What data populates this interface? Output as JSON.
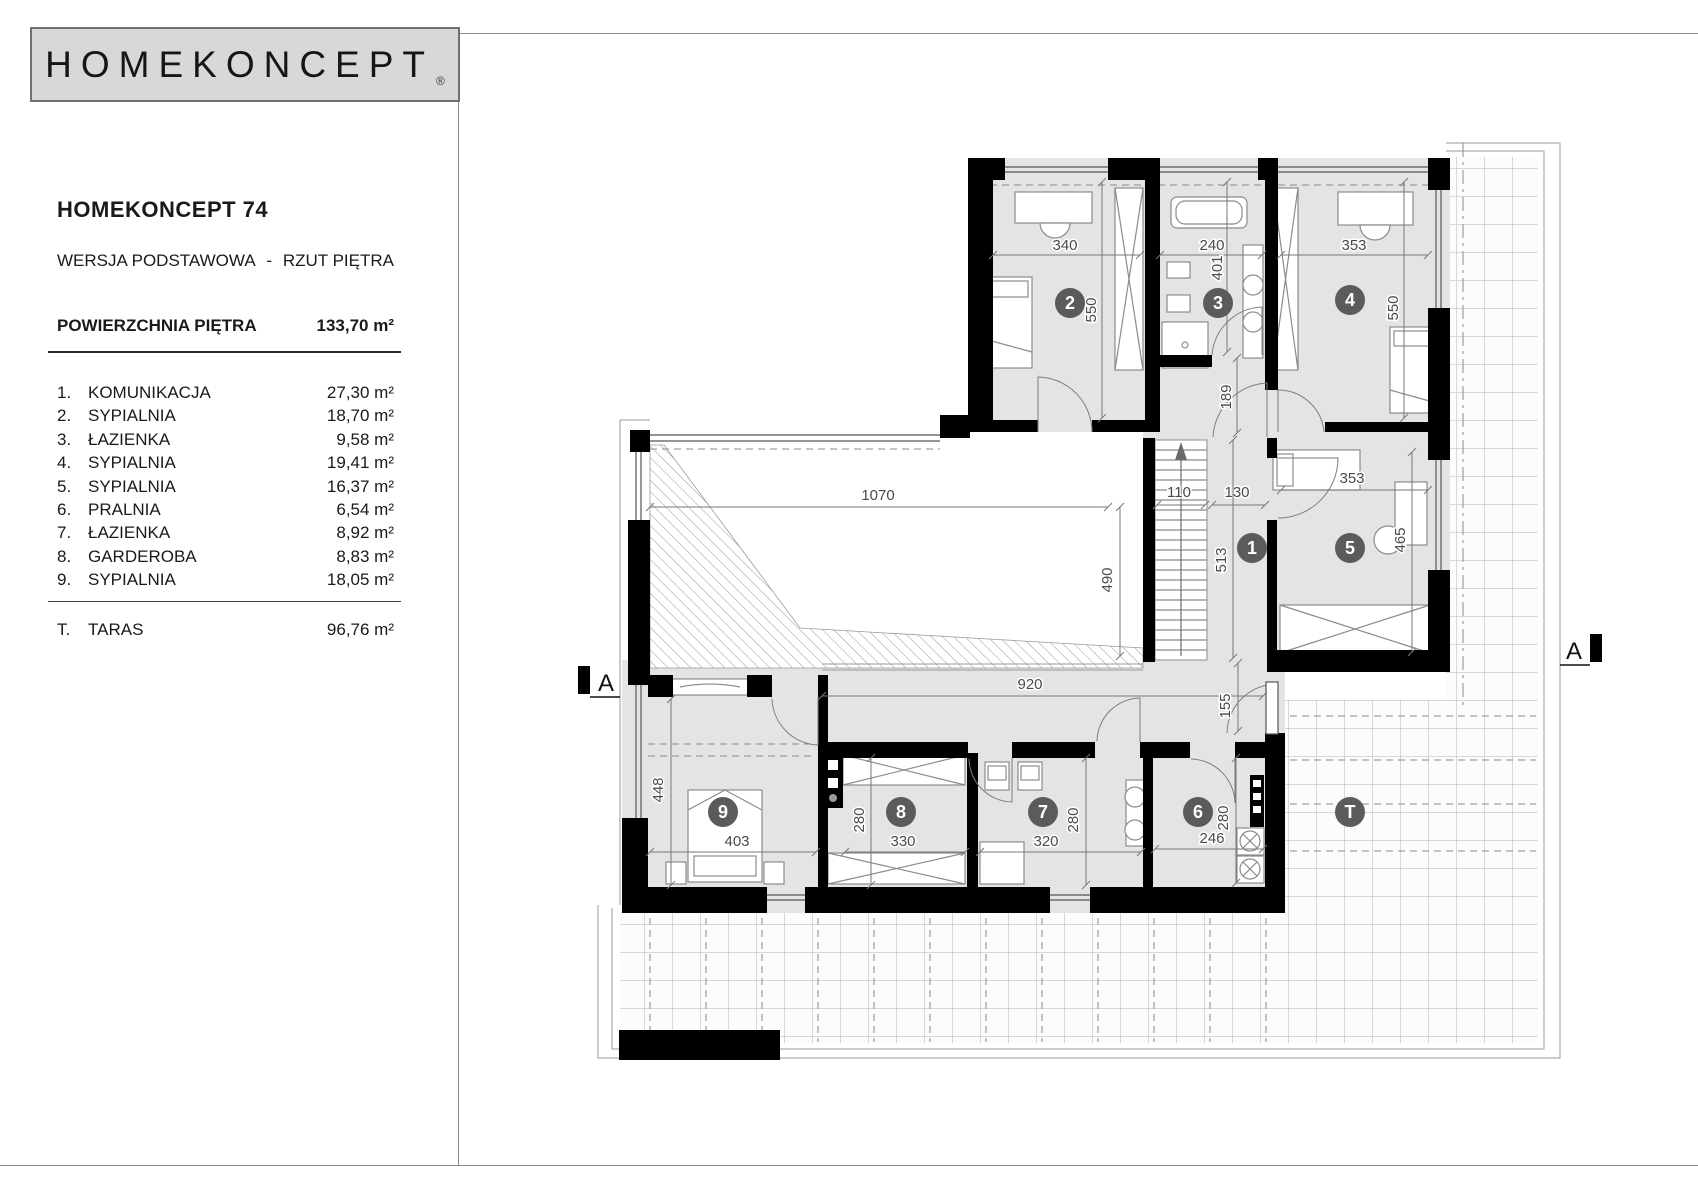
{
  "logo": {
    "text": "HOMEKONCEPT",
    "registered": "®"
  },
  "sidebar": {
    "title": "HOMEKONCEPT 74",
    "subtitle_left": "WERSJA PODSTAWOWA",
    "subtitle_dash": "-",
    "subtitle_right": "RZUT PIĘTRA",
    "area_label": "POWIERZCHNIA PIĘTRA",
    "area_value": "133,70 m²",
    "rooms": [
      {
        "no": "1.",
        "name": "KOMUNIKACJA",
        "area": "27,30 m²"
      },
      {
        "no": "2.",
        "name": "SYPIALNIA",
        "area": "18,70 m²"
      },
      {
        "no": "3.",
        "name": "ŁAZIENKA",
        "area": "9,58 m²"
      },
      {
        "no": "4.",
        "name": "SYPIALNIA",
        "area": "19,41 m²"
      },
      {
        "no": "5.",
        "name": "SYPIALNIA",
        "area": "16,37 m²"
      },
      {
        "no": "6.",
        "name": "PRALNIA",
        "area": "6,54 m²"
      },
      {
        "no": "7.",
        "name": "ŁAZIENKA",
        "area": "8,92 m²"
      },
      {
        "no": "8.",
        "name": "GARDEROBA",
        "area": "8,83 m²"
      },
      {
        "no": "9.",
        "name": "SYPIALNIA",
        "area": "18,05 m²"
      }
    ],
    "terrace_row": {
      "no": "T.",
      "name": "TARAS",
      "area": "96,76 m²"
    }
  },
  "plan": {
    "section_markers": {
      "left": "A",
      "right": "A"
    },
    "room_markers": [
      {
        "t": "1",
        "x": 1252,
        "y": 548
      },
      {
        "t": "2",
        "x": 1070,
        "y": 303
      },
      {
        "t": "3",
        "x": 1218,
        "y": 303
      },
      {
        "t": "4",
        "x": 1350,
        "y": 300
      },
      {
        "t": "5",
        "x": 1350,
        "y": 548
      },
      {
        "t": "6",
        "x": 1198,
        "y": 812
      },
      {
        "t": "7",
        "x": 1043,
        "y": 812
      },
      {
        "t": "8",
        "x": 901,
        "y": 812
      },
      {
        "t": "9",
        "x": 723,
        "y": 812
      },
      {
        "t": "T",
        "x": 1350,
        "y": 812
      }
    ],
    "dimensions": [
      {
        "text": "340",
        "lx": 1065,
        "ly": 250,
        "x1": 993,
        "y1": 255,
        "x2": 1140,
        "y2": 255,
        "rot": 0
      },
      {
        "text": "240",
        "lx": 1212,
        "ly": 250,
        "x1": 1160,
        "y1": 255,
        "x2": 1262,
        "y2": 255,
        "rot": 0
      },
      {
        "text": "353",
        "lx": 1354,
        "ly": 250,
        "x1": 1281,
        "y1": 255,
        "x2": 1428,
        "y2": 255,
        "rot": 0
      },
      {
        "text": "401",
        "lx": 1222,
        "ly": 268,
        "x1": 1227,
        "y1": 182,
        "x2": 1227,
        "y2": 352,
        "rot": 1
      },
      {
        "text": "550",
        "lx": 1096,
        "ly": 310,
        "x1": 1102,
        "y1": 182,
        "x2": 1102,
        "y2": 418,
        "rot": 1
      },
      {
        "text": "550",
        "lx": 1398,
        "ly": 308,
        "x1": 1404,
        "y1": 182,
        "x2": 1404,
        "y2": 418,
        "rot": 1
      },
      {
        "text": "189",
        "lx": 1231,
        "ly": 397,
        "x1": 1237,
        "y1": 358,
        "x2": 1237,
        "y2": 433,
        "rot": 1
      },
      {
        "text": "1070",
        "lx": 878,
        "ly": 500,
        "x1": 650,
        "y1": 507,
        "x2": 1108,
        "y2": 507,
        "rot": 0
      },
      {
        "text": "490",
        "lx": 1112,
        "ly": 580,
        "x1": 1120,
        "y1": 507,
        "x2": 1120,
        "y2": 656,
        "rot": 1
      },
      {
        "text": "110",
        "lx": 1179,
        "ly": 497,
        "x1": 1157,
        "y1": 505,
        "x2": 1205,
        "y2": 505,
        "rot": 0
      },
      {
        "text": "130",
        "lx": 1237,
        "ly": 497,
        "x1": 1212,
        "y1": 505,
        "x2": 1265,
        "y2": 505,
        "rot": 0
      },
      {
        "text": "513",
        "lx": 1226,
        "ly": 560,
        "x1": 1233,
        "y1": 440,
        "x2": 1233,
        "y2": 658,
        "rot": 1
      },
      {
        "text": "353",
        "lx": 1352,
        "ly": 483,
        "x1": 1281,
        "y1": 490,
        "x2": 1428,
        "y2": 490,
        "rot": 0
      },
      {
        "text": "465",
        "lx": 1405,
        "ly": 540,
        "x1": 1412,
        "y1": 452,
        "x2": 1412,
        "y2": 652,
        "rot": 1
      },
      {
        "text": "920",
        "lx": 1030,
        "ly": 689,
        "x1": 822,
        "y1": 696,
        "x2": 1263,
        "y2": 696,
        "rot": 0
      },
      {
        "text": "155",
        "lx": 1230,
        "ly": 706,
        "x1": 1238,
        "y1": 663,
        "x2": 1238,
        "y2": 731,
        "rot": 1
      },
      {
        "text": "448",
        "lx": 663,
        "ly": 790,
        "x1": 671,
        "y1": 699,
        "x2": 671,
        "y2": 885,
        "rot": 1
      },
      {
        "text": "403",
        "lx": 737,
        "ly": 846,
        "x1": 650,
        "y1": 852,
        "x2": 816,
        "y2": 852,
        "rot": 0
      },
      {
        "text": "280",
        "lx": 864,
        "ly": 820,
        "x1": 871,
        "y1": 758,
        "x2": 871,
        "y2": 885,
        "rot": 1
      },
      {
        "text": "330",
        "lx": 903,
        "ly": 846,
        "x1": 845,
        "y1": 852,
        "x2": 965,
        "y2": 852,
        "rot": 0
      },
      {
        "text": "320",
        "lx": 1046,
        "ly": 846,
        "x1": 980,
        "y1": 852,
        "x2": 1141,
        "y2": 852,
        "rot": 0
      },
      {
        "text": "280",
        "lx": 1078,
        "ly": 820,
        "x1": 1086,
        "y1": 758,
        "x2": 1086,
        "y2": 885,
        "rot": 1
      },
      {
        "text": "246",
        "lx": 1212,
        "ly": 843,
        "x1": 1155,
        "y1": 849,
        "x2": 1263,
        "y2": 849,
        "rot": 0
      },
      {
        "text": "280",
        "lx": 1228,
        "ly": 818,
        "x1": 1236,
        "y1": 758,
        "x2": 1236,
        "y2": 883,
        "rot": 1
      }
    ]
  },
  "colors": {
    "floor": "#e4e4e4",
    "wall": "#000000",
    "badge": "#5b5b5b",
    "logo_bg": "#d8d8d8",
    "dim_text": "#4a4a4a",
    "tile_line": "#b3b3b3"
  }
}
